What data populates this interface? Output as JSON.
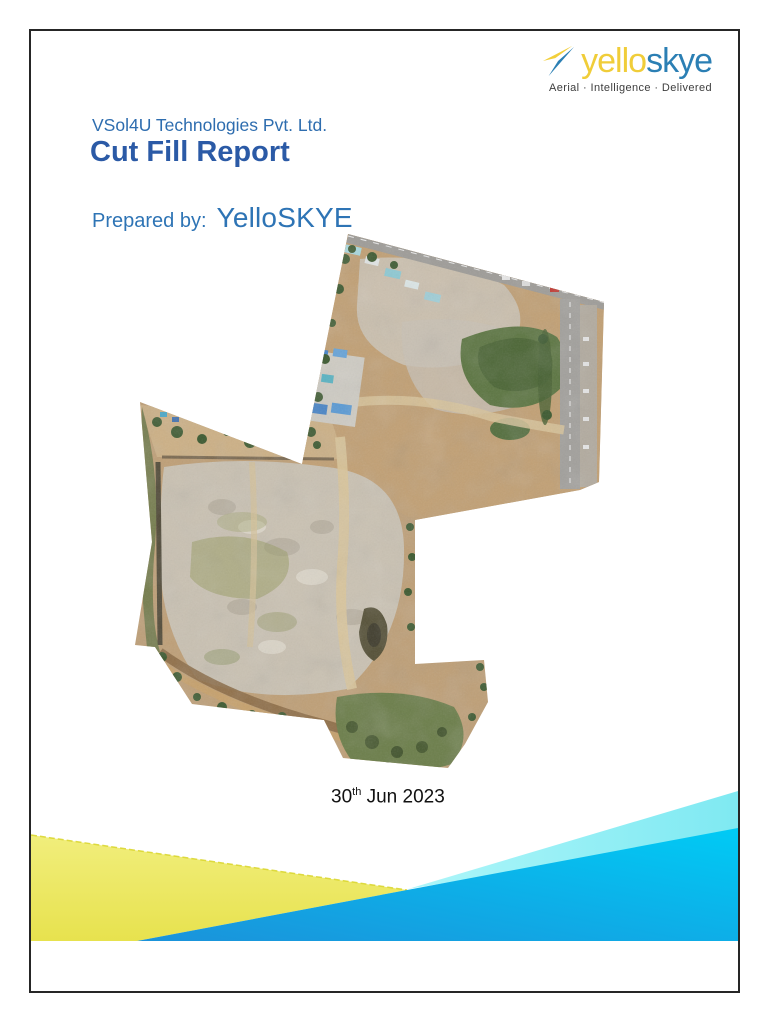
{
  "logo": {
    "icon": "paper-plane-icon",
    "brand_first": "yello",
    "brand_second": "skye",
    "tagline": "Aerial · Intelligence · Delivered",
    "colors": {
      "brand_yellow": "#f0cd39",
      "brand_blue": "#2b7fb4"
    }
  },
  "page": {
    "company": "VSol4U Technologies Pvt. Ltd.",
    "report_title": "Cut Fill Report",
    "prepared_by_label": "Prepared by:",
    "prepared_by_value": "YelloSKYE",
    "date": {
      "day": "30",
      "ordinal": "th",
      "rest": "Jun 2023",
      "full": "30th Jun 2023"
    }
  },
  "map": {
    "alt": "Aerial drone orthomosaic of construction site with roads, ponds, rubble fields and vegetation"
  },
  "decor": {
    "yellow": "#e9e55c",
    "yellow_edge": "#d9d52a",
    "cyan_light": "#97f1f7",
    "blue_start": "#1b92da",
    "blue_end": "#00cbf5"
  },
  "text_colors": {
    "heading_blue": "#2e6daf",
    "title_blue": "#2b5aa6",
    "date_black": "#111111"
  }
}
